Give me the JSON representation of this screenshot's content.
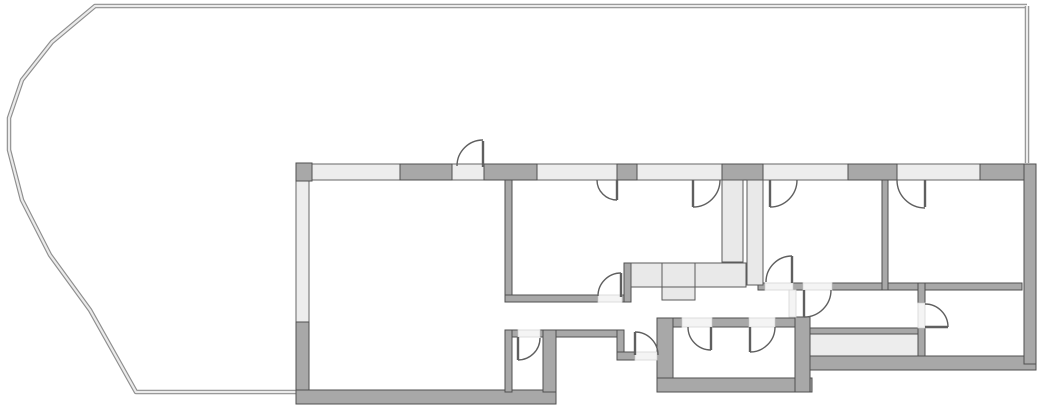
{
  "canvas": {
    "width": 1042,
    "height": 416,
    "background": "#ffffff"
  },
  "colors": {
    "wall_fill": "#a8a8a8",
    "wall_stroke": "#4f4f4f",
    "window_fill": "#ededed",
    "window_stroke": "#666666",
    "fixture_fill": "#e9e9e9",
    "fixture_stroke": "#5a5a5a",
    "threshold_fill": "#f4f4f4",
    "threshold_stroke": "#d6d6d6",
    "door_stroke": "#5f5f5f",
    "terrace_outer": "#8f8f8f",
    "terrace_inner": "#ebebeb"
  },
  "terrace": {
    "outer_path": "M1027,6 L95,6 L52,42 L22,80 L9,118 L9,150 L22,200 L50,255 L90,310 L136,392 L296,392",
    "right_edge_path": "M1027,6 L1027,163"
  },
  "walls": [
    [
      296,
      163,
      16,
      18
    ],
    [
      400,
      164,
      52,
      16
    ],
    [
      484,
      164,
      53,
      16
    ],
    [
      617,
      164,
      20,
      16
    ],
    [
      722,
      164,
      41,
      16
    ],
    [
      848,
      164,
      49,
      16
    ],
    [
      980,
      164,
      56,
      16
    ],
    [
      296,
      322,
      13,
      82
    ],
    [
      296,
      390,
      260,
      14
    ],
    [
      505,
      180,
      7,
      122
    ],
    [
      505,
      295,
      93,
      7
    ],
    [
      622,
      295,
      8,
      7
    ],
    [
      624,
      263,
      7,
      39
    ],
    [
      505,
      330,
      13,
      7
    ],
    [
      540,
      330,
      16,
      7
    ],
    [
      505,
      330,
      7,
      62
    ],
    [
      543,
      330,
      13,
      62
    ],
    [
      556,
      330,
      68,
      7
    ],
    [
      617,
      330,
      7,
      30
    ],
    [
      617,
      352,
      18,
      8
    ],
    [
      657,
      318,
      25,
      9
    ],
    [
      712,
      318,
      37,
      9
    ],
    [
      775,
      318,
      20,
      9
    ],
    [
      657,
      318,
      16,
      74
    ],
    [
      657,
      378,
      155,
      14
    ],
    [
      795,
      317,
      15,
      75
    ],
    [
      810,
      328,
      108,
      6
    ],
    [
      810,
      356,
      226,
      14
    ],
    [
      1024,
      164,
      12,
      200
    ],
    [
      758,
      283,
      7,
      7
    ],
    [
      793,
      283,
      10,
      7
    ],
    [
      832,
      283,
      190,
      7
    ],
    [
      882,
      180,
      6,
      110
    ],
    [
      918,
      283,
      7,
      20
    ],
    [
      918,
      328,
      7,
      28
    ]
  ],
  "windows": [
    [
      310,
      164,
      90,
      16
    ],
    [
      452,
      164,
      32,
      16
    ],
    [
      537,
      164,
      80,
      16
    ],
    [
      637,
      164,
      85,
      16
    ],
    [
      763,
      164,
      85,
      16
    ],
    [
      897,
      164,
      83,
      16
    ],
    [
      296,
      180,
      13,
      142
    ],
    [
      810,
      334,
      108,
      22
    ]
  ],
  "shafts": [
    [
      722,
      180,
      21,
      82
    ],
    [
      747,
      180,
      16,
      105
    ]
  ],
  "counter_cells": [
    [
      631,
      263,
      31,
      24
    ],
    [
      662,
      263,
      33,
      24
    ],
    [
      695,
      263,
      51,
      24
    ],
    [
      662,
      287,
      33,
      13
    ]
  ],
  "thresholds": [
    [
      598,
      295,
      24,
      7
    ],
    [
      518,
      330,
      22,
      7
    ],
    [
      635,
      352,
      22,
      8
    ],
    [
      682,
      318,
      30,
      9
    ],
    [
      749,
      318,
      26,
      9
    ],
    [
      765,
      283,
      28,
      7
    ],
    [
      803,
      283,
      29,
      7
    ],
    [
      789,
      290,
      7,
      27
    ],
    [
      918,
      303,
      7,
      25
    ]
  ],
  "doors": [
    {
      "name": "terrace-door-living",
      "leaf": [
        483,
        167,
        483,
        141
      ],
      "arc": "M457,166 A26,26 0 0 1 483,140"
    },
    {
      "name": "terrace-door-room-1",
      "leaf": [
        617,
        180,
        617,
        200
      ],
      "arc": "M597,180 A20,20 0 0 0 617,200"
    },
    {
      "name": "terrace-door-kitchen",
      "leaf": [
        693,
        180,
        693,
        207
      ],
      "arc": "M720,180 A27,27 0 0 1 693,207"
    },
    {
      "name": "terrace-door-room-2",
      "leaf": [
        770,
        180,
        770,
        207
      ],
      "arc": "M797,180 A27,27 0 0 1 770,207"
    },
    {
      "name": "terrace-door-room-3",
      "leaf": [
        925,
        180,
        925,
        207
      ],
      "arc": "M897,180 A28,28 0 0 0 925,208"
    },
    {
      "name": "room-1-hall-door",
      "leaf": [
        621,
        297,
        621,
        273
      ],
      "arc": "M598,296 A23,23 0 0 1 621,273"
    },
    {
      "name": "wc-door",
      "leaf": [
        518,
        337,
        518,
        360
      ],
      "arc": "M518,360 A22,22 0 0 0 540,338"
    },
    {
      "name": "entry-door",
      "leaf": [
        635,
        355,
        635,
        332
      ],
      "arc": "M635,332 A23,23 0 0 1 658,355"
    },
    {
      "name": "bath-door-left",
      "leaf": [
        711,
        327,
        711,
        350
      ],
      "arc": "M688,327 A23,23 0 0 0 711,350"
    },
    {
      "name": "bath-door-right",
      "leaf": [
        750,
        327,
        750,
        352
      ],
      "arc": "M775,327 A25,25 0 0 1 750,352"
    },
    {
      "name": "room-2-hall-door",
      "leaf": [
        792,
        283,
        792,
        256
      ],
      "arc": "M766,282 A26,26 0 0 1 792,256"
    },
    {
      "name": "hall-door",
      "leaf": [
        804,
        290,
        804,
        317
      ],
      "arc": "M804,317 A27,27 0 0 0 831,290"
    },
    {
      "name": "room-4-door",
      "leaf": [
        925,
        327,
        948,
        327
      ],
      "arc": "M948,327 A23,23 0 0 0 925,304"
    }
  ]
}
